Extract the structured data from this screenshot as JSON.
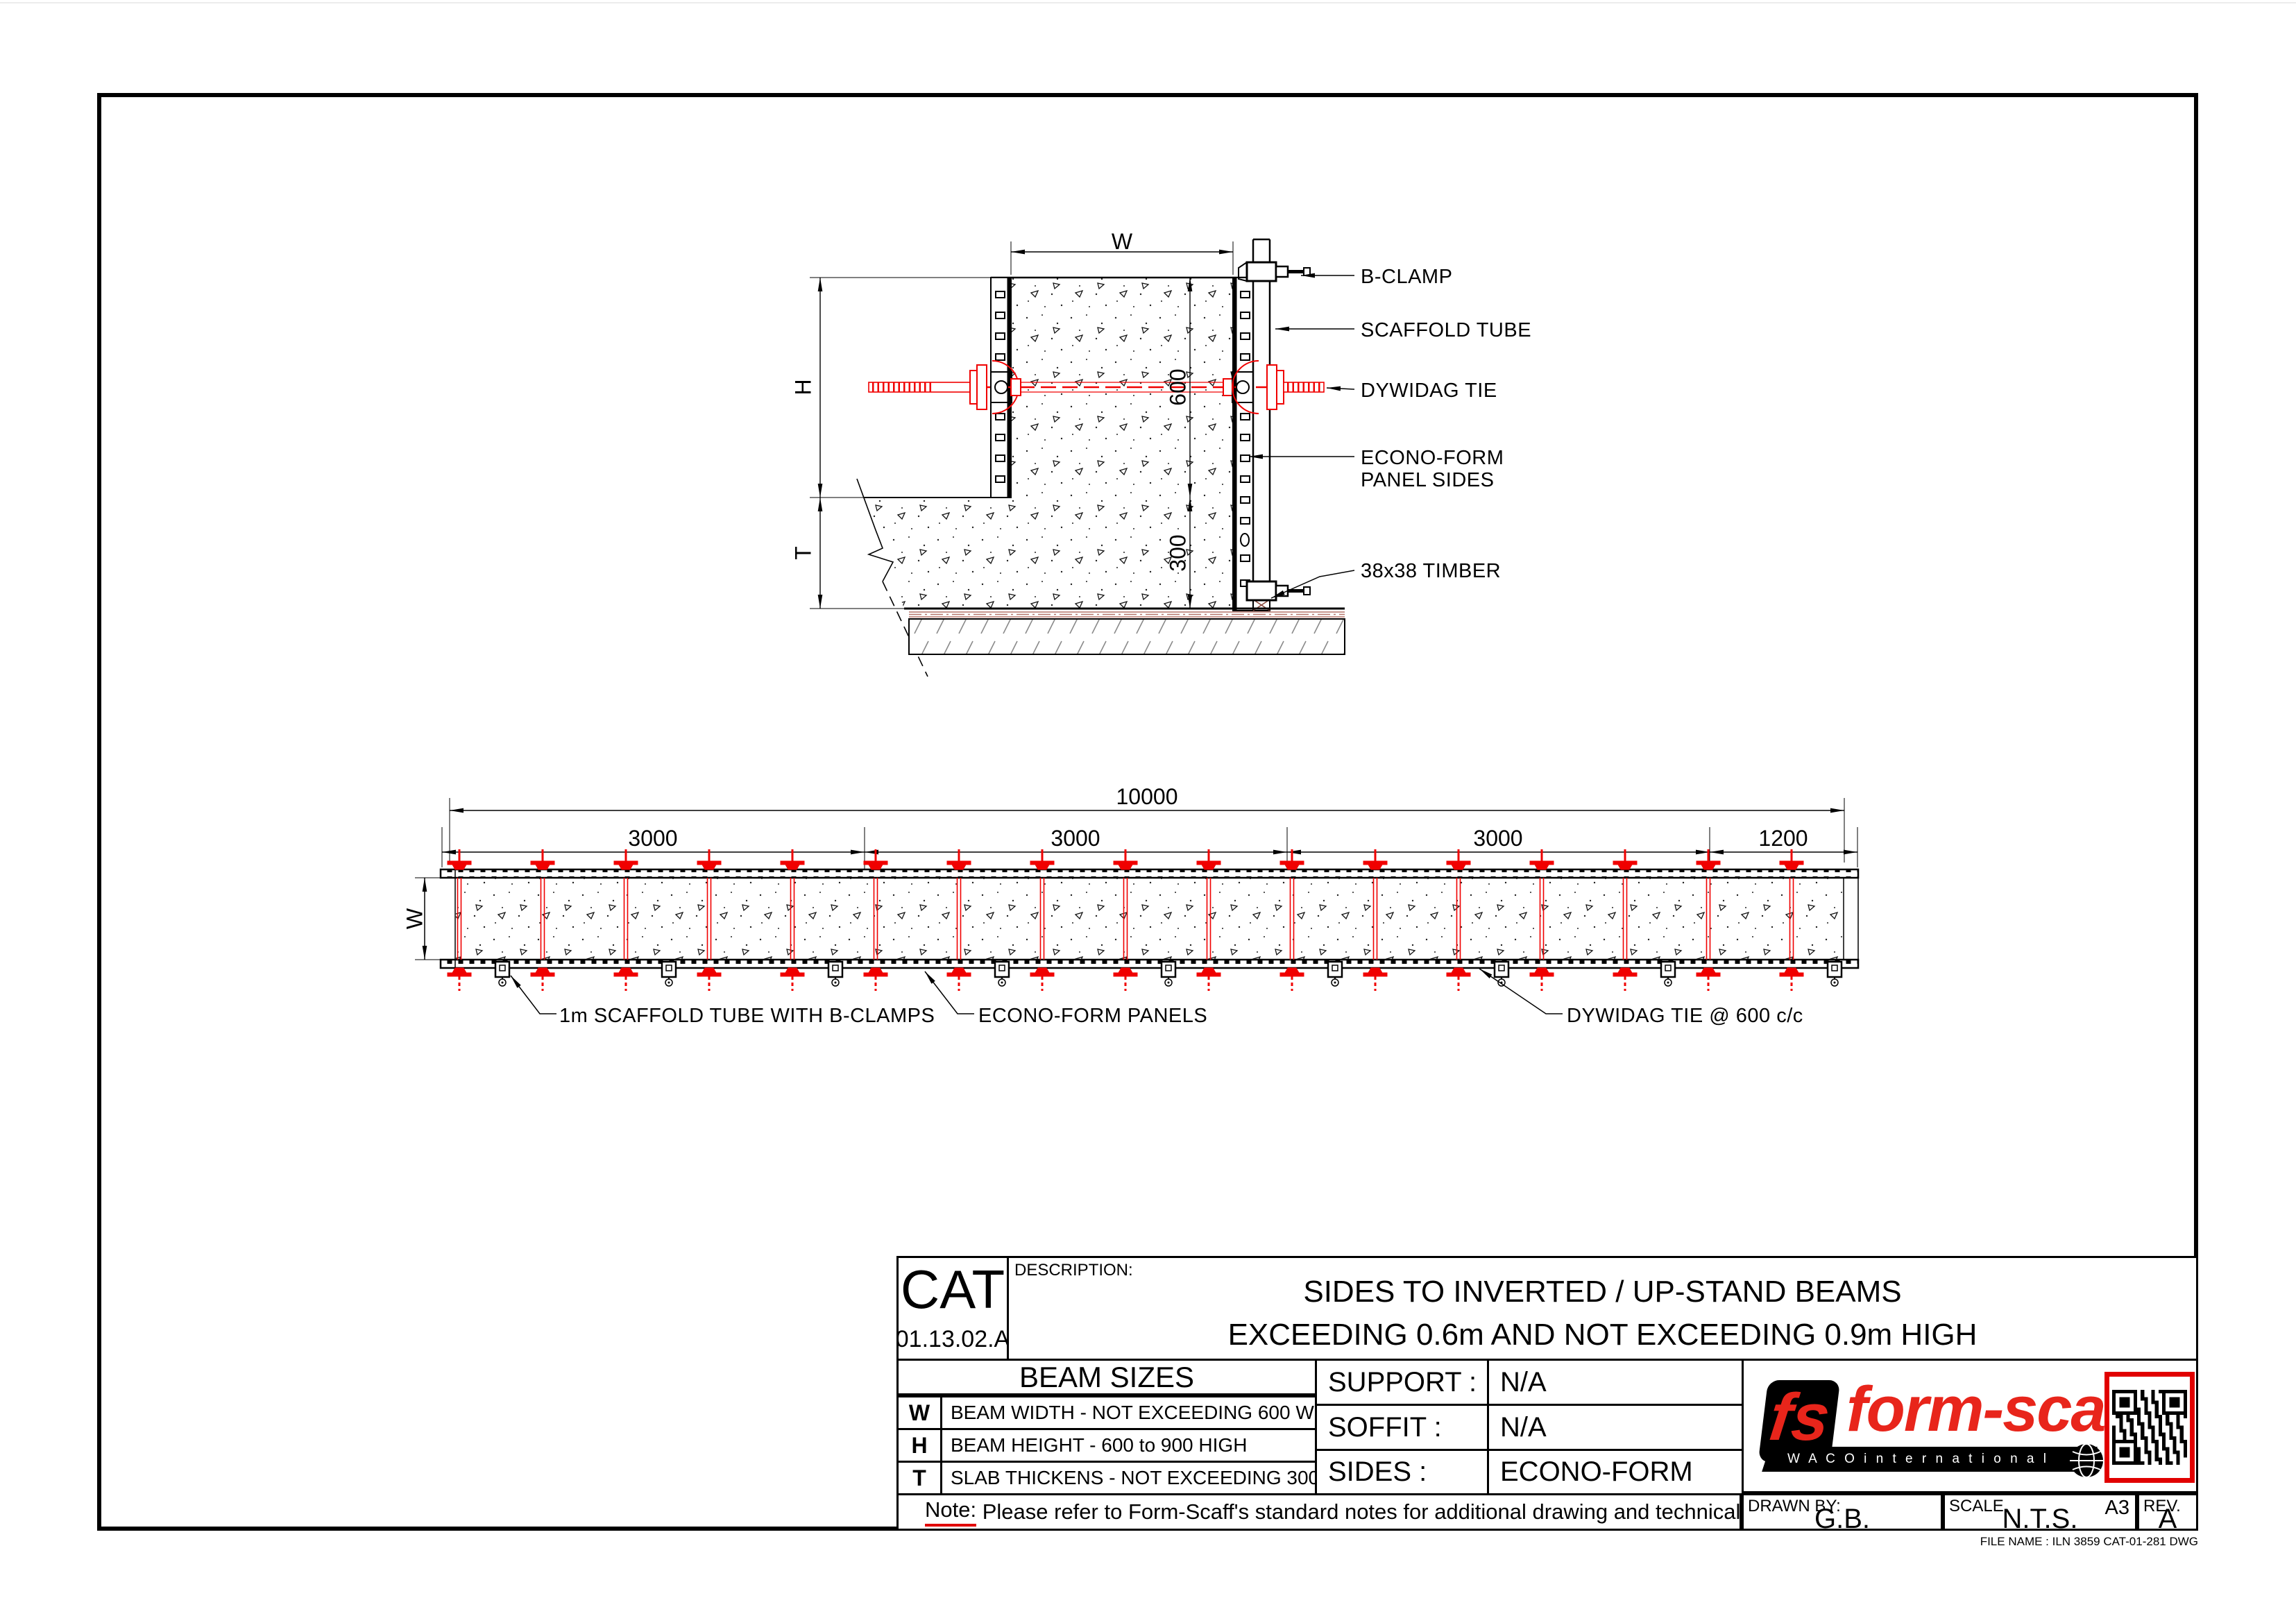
{
  "colors": {
    "cad_red": "#f00000",
    "logo_red": "#e8251b",
    "note_red": "#e10000",
    "base_brown": "#b5756a"
  },
  "cross_section": {
    "dims": {
      "width": "W",
      "height": "H",
      "slab": "T",
      "beam_height": "600",
      "slab_thickness": "300"
    },
    "labels": {
      "b_clamp": "B-CLAMP",
      "scaffold_tube": "SCAFFOLD TUBE",
      "dywidag_tie": "DYWIDAG TIE",
      "panel_sides_line1": "ECONO-FORM",
      "panel_sides_line2": "PANEL SIDES",
      "timber": "38x38 TIMBER"
    }
  },
  "plan": {
    "dims": {
      "overall": "10000",
      "seg1": "3000",
      "seg2": "3000",
      "seg3": "3000",
      "seg4": "1200",
      "width": "W"
    },
    "labels": {
      "scaffold_tube": "1m SCAFFOLD TUBE WITH B-CLAMPS",
      "panels": "ECONO-FORM PANELS",
      "tie_spacing": "DYWIDAG TIE @ 600 c/c"
    }
  },
  "title_block": {
    "cat_label": "CAT",
    "cat_no": "01.13.02.A",
    "description_label": "DESCRIPTION:",
    "description_line1": "SIDES TO INVERTED / UP-STAND BEAMS",
    "description_line2": "EXCEEDING 0.6m AND NOT EXCEEDING 0.9m HIGH",
    "beam_sizes": {
      "title": "BEAM SIZES",
      "rows": [
        {
          "key": "W",
          "desc": "BEAM WIDTH - NOT EXCEEDING 600 WIDE"
        },
        {
          "key": "H",
          "desc": "BEAM HEIGHT - 600 to 900 HIGH"
        },
        {
          "key": "T",
          "desc": "SLAB THICKENS - NOT EXCEEDING 300 THICK"
        }
      ]
    },
    "specs": [
      {
        "label": "SUPPORT :",
        "value": "N/A"
      },
      {
        "label": "SOFFIT :",
        "value": "N/A"
      },
      {
        "label": "SIDES :",
        "value": "ECONO-FORM"
      }
    ],
    "note_label": "Note:",
    "note_text": " Please refer to Form-Scaff's standard notes for additional drawing and technical notes.",
    "drawn_by_label": "DRAWN BY:",
    "drawn_by": "G.B.",
    "scale_label": "SCALE",
    "scale": "N.T.S.",
    "paper_size": "A3",
    "rev_label": "REV.",
    "rev": "A",
    "logo": {
      "emblem": "fs",
      "word": "form-scaff",
      "banner": "W A C O   i n t e r n a t i o n a l"
    },
    "file_name": "FILE NAME : ILN 3859 CAT-01-281 DWG"
  }
}
